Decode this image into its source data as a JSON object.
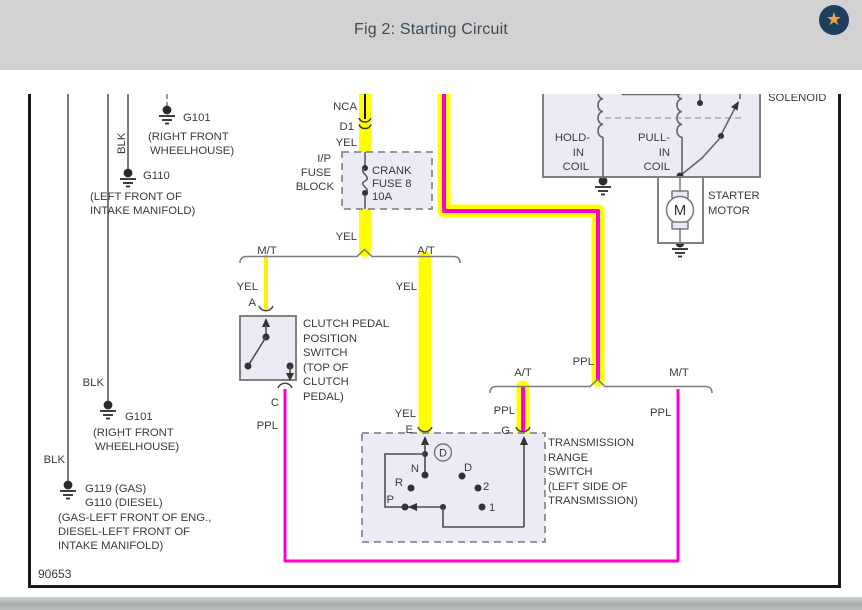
{
  "header": {
    "title": "Fig 2: Starting Circuit"
  },
  "icons": {
    "favorite_star": "★"
  },
  "footer": {
    "diagram_code": "90653"
  },
  "colors": {
    "highlight_yellow": "#ffff00",
    "wire_purple": "#ff00cc",
    "wire_gray": "#7c7c7c",
    "component_fill": "#eaebf5",
    "header_bg": "#d2d2d2"
  },
  "grounds": {
    "g101_top": {
      "id": "G101",
      "loc1": "(RIGHT FRONT",
      "loc2": "WHEELHOUSE)"
    },
    "g110_top": {
      "id": "G110",
      "loc1": "(LEFT FRONT OF",
      "loc2": "INTAKE MANIFOLD)",
      "wire": "BLK"
    },
    "g101_left": {
      "id": "G101",
      "loc1": "(RIGHT FRONT",
      "loc2": "WHEELHOUSE)",
      "wire": "BLK"
    },
    "g119_left": {
      "id1": "G119 (GAS)",
      "id2": "G110 (DIESEL)",
      "loc1": "(GAS-LEFT FRONT OF ENG.,",
      "loc2": "DIESEL-LEFT FRONT OF",
      "loc3": "INTAKE MANIFOLD)",
      "wire": "BLK"
    }
  },
  "feed": {
    "nca": "NCA",
    "connector": "D1",
    "yel_above_fuse": "YEL",
    "yel_below_fuse": "YEL"
  },
  "fuse_block": {
    "name1": "I/P",
    "name2": "FUSE",
    "name3": "BLOCK",
    "fuse_line1": "CRANK",
    "fuse_line2": "FUSE 8",
    "fuse_line3": "10A"
  },
  "split1": {
    "left": "M/T",
    "right": "A/T"
  },
  "clutch": {
    "wire_label": "YEL",
    "term_a": "A",
    "term_c": "C",
    "out_wire": "PPL",
    "name1": "CLUTCH PEDAL",
    "name2": "POSITION",
    "name3": "SWITCH",
    "name4": "(TOP OF",
    "name5": "CLUTCH",
    "name6": "PEDAL)"
  },
  "at_branch": {
    "wire_top": "YEL",
    "wire_bottom": "YEL",
    "term_e": "E"
  },
  "split2": {
    "feed_wire": "PPL",
    "left": "A/T",
    "right": "M/T",
    "left_wire": "PPL",
    "right_wire": "PPL",
    "term_g": "G"
  },
  "trs": {
    "name1": "TRANSMISSION",
    "name2": "RANGE",
    "name3": "SWITCH",
    "name4": "(LEFT SIDE OF",
    "name5": "TRANSMISSION)",
    "pos_d_circle": "D",
    "pos_n": "N",
    "pos_d": "D",
    "pos_r": "R",
    "pos_2": "2",
    "pos_p": "P",
    "pos_1": "1"
  },
  "solenoid": {
    "name": "SOLENOID",
    "hold1": "HOLD-",
    "hold2": "IN",
    "hold3": "COIL",
    "pull1": "PULL-",
    "pull2": "IN",
    "pull3": "COIL"
  },
  "starter": {
    "name1": "STARTER",
    "name2": "MOTOR",
    "motor_m": "M"
  }
}
